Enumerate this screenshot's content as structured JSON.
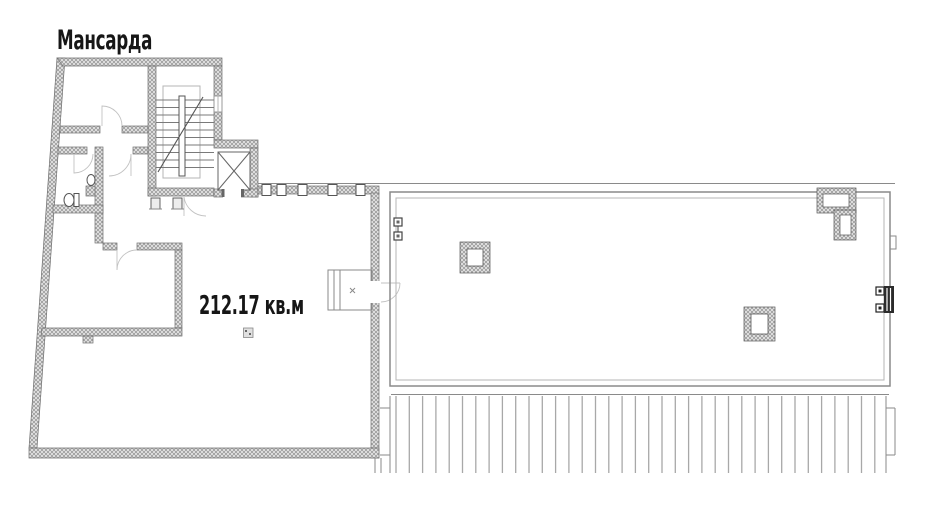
{
  "plan": {
    "title": "Мансарда",
    "area_label": "212.17 кв.м"
  },
  "colors": {
    "background": "#ffffff",
    "ink": "#161616",
    "wall_line": "#6f6f6f",
    "thin_line": "#8a8a8a",
    "light_line": "#b5b5b5",
    "dark_fill": "#2b2b2b"
  }
}
